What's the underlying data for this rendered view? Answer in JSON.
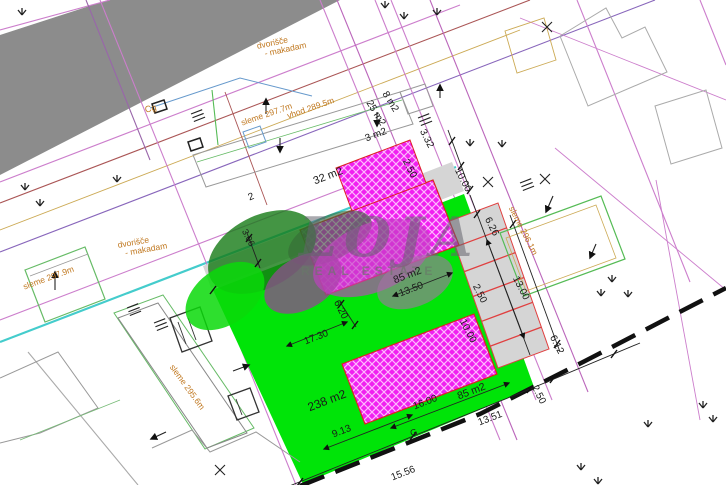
{
  "watermark": {
    "brand": "LOJA",
    "subtitle": "REAL ESTATE"
  },
  "labels": {
    "area_32": "32 m2",
    "area_8": "8 m2",
    "area_25": "25 m2",
    "area_3": "3 m2",
    "area_85_top": "85 m2",
    "area_85_bottom": "85 m2",
    "area_238": "238 m2",
    "dim_13_50": "13.50",
    "dim_16_00": "16.00",
    "dim_9_13": "9.13",
    "dim_17_30": "17.30",
    "dim_6_20": "6.20",
    "dim_3_06": "3.06",
    "dim_2_50_a": "2.50",
    "dim_3_32": "3.32",
    "dim_10_00_a": "10.00",
    "dim_6_26": "6.26",
    "dim_2_50_b": "2.50",
    "dim_10_00_b": "10.00",
    "dim_13_00": "13.00",
    "dim_6_12": "6.12",
    "dim_2_50_c": "2.50",
    "dim_13_51": "13.51",
    "dim_15_56": "15.56",
    "marker_g": "G",
    "parcel_2": "2",
    "marker_cg": "Cg",
    "yard_top_line1": "dvorišče",
    "yard_top_line2": "- makadam",
    "yard_left_line1": "dvorišče",
    "yard_left_line2": "- makadam",
    "ridge_top": "sleme 297.7m",
    "entrance_top": "vhod 289.5m",
    "ridge_left": "sleme 297.9m",
    "ridge_long": "sleme 295.6m",
    "ridge_right": "sleme 296.1m"
  },
  "colors": {
    "road_gray": "#8c8c8c",
    "plot_green": "#00e408",
    "building_hatch_magenta": "#f020f0",
    "parking_gray": "#d5d5d5",
    "stall_red": "#e04040",
    "parcel_magenta": "#cc7ecc",
    "utility_cyan": "#44cccc",
    "annotation_orange": "#c07820",
    "boundary_black": "#111111"
  }
}
